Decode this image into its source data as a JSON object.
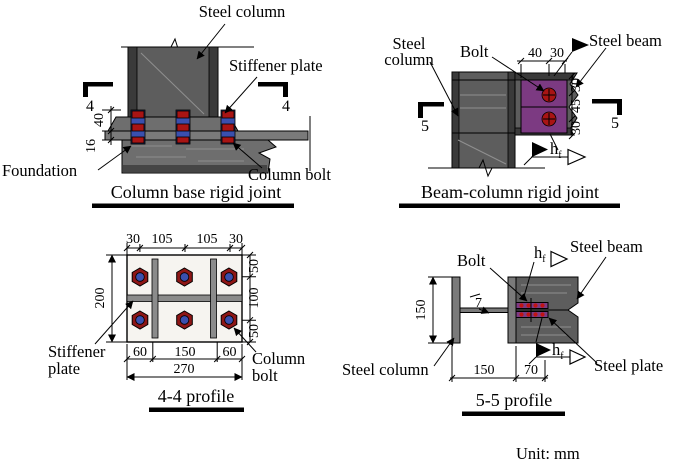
{
  "unit_label": "Unit: mm",
  "colors": {
    "steel": "#5d5d5d",
    "steel_dark": "#3a3a3a",
    "steel_mid": "#7a7a7a",
    "plate_purple": "#7c3a82",
    "bolt_red": "#a81414",
    "bolt_blue": "#3a4fae",
    "line": "#000000",
    "background": "#ffffff"
  },
  "column_base": {
    "title": "Column base rigid joint",
    "steel_column": "Steel column",
    "stiffener_plate": "Stiffener plate",
    "foundation": "Foundation",
    "column_bolt": "Column bolt",
    "section": "4",
    "dim_40": "40",
    "dim_16": "16"
  },
  "beam_column": {
    "title": "Beam-column rigid joint",
    "steel_line1": "Steel",
    "steel_line2": "column",
    "bolt": "Bolt",
    "steel_beam": "Steel beam",
    "section": "5",
    "dim_top": [
      "40",
      "30"
    ],
    "dim_side": [
      "30",
      "45",
      "30"
    ],
    "weld_base": "h",
    "weld_sub": "f"
  },
  "profile44": {
    "title": "4-4 profile",
    "stiffener_line1": "Stiffener",
    "stiffener_line2": "plate",
    "bolt_line1": "Column",
    "bolt_line2": "bolt",
    "dim_top": [
      "30",
      "105",
      "105",
      "30"
    ],
    "dim_left": "200",
    "dim_right": [
      "50",
      "100",
      "50"
    ],
    "dim_bottom": [
      "60",
      "150",
      "60"
    ],
    "dim_width": "270"
  },
  "profile55": {
    "title": "5-5 profile",
    "bolt": "Bolt",
    "steel_beam": "Steel beam",
    "steel_column": "Steel column",
    "steel_plate": "Steel plate",
    "dim_flange": "150",
    "dim_weld": "7",
    "dim_bottom": [
      "150",
      "70"
    ],
    "weld_base": "h",
    "weld_sub": "f"
  }
}
